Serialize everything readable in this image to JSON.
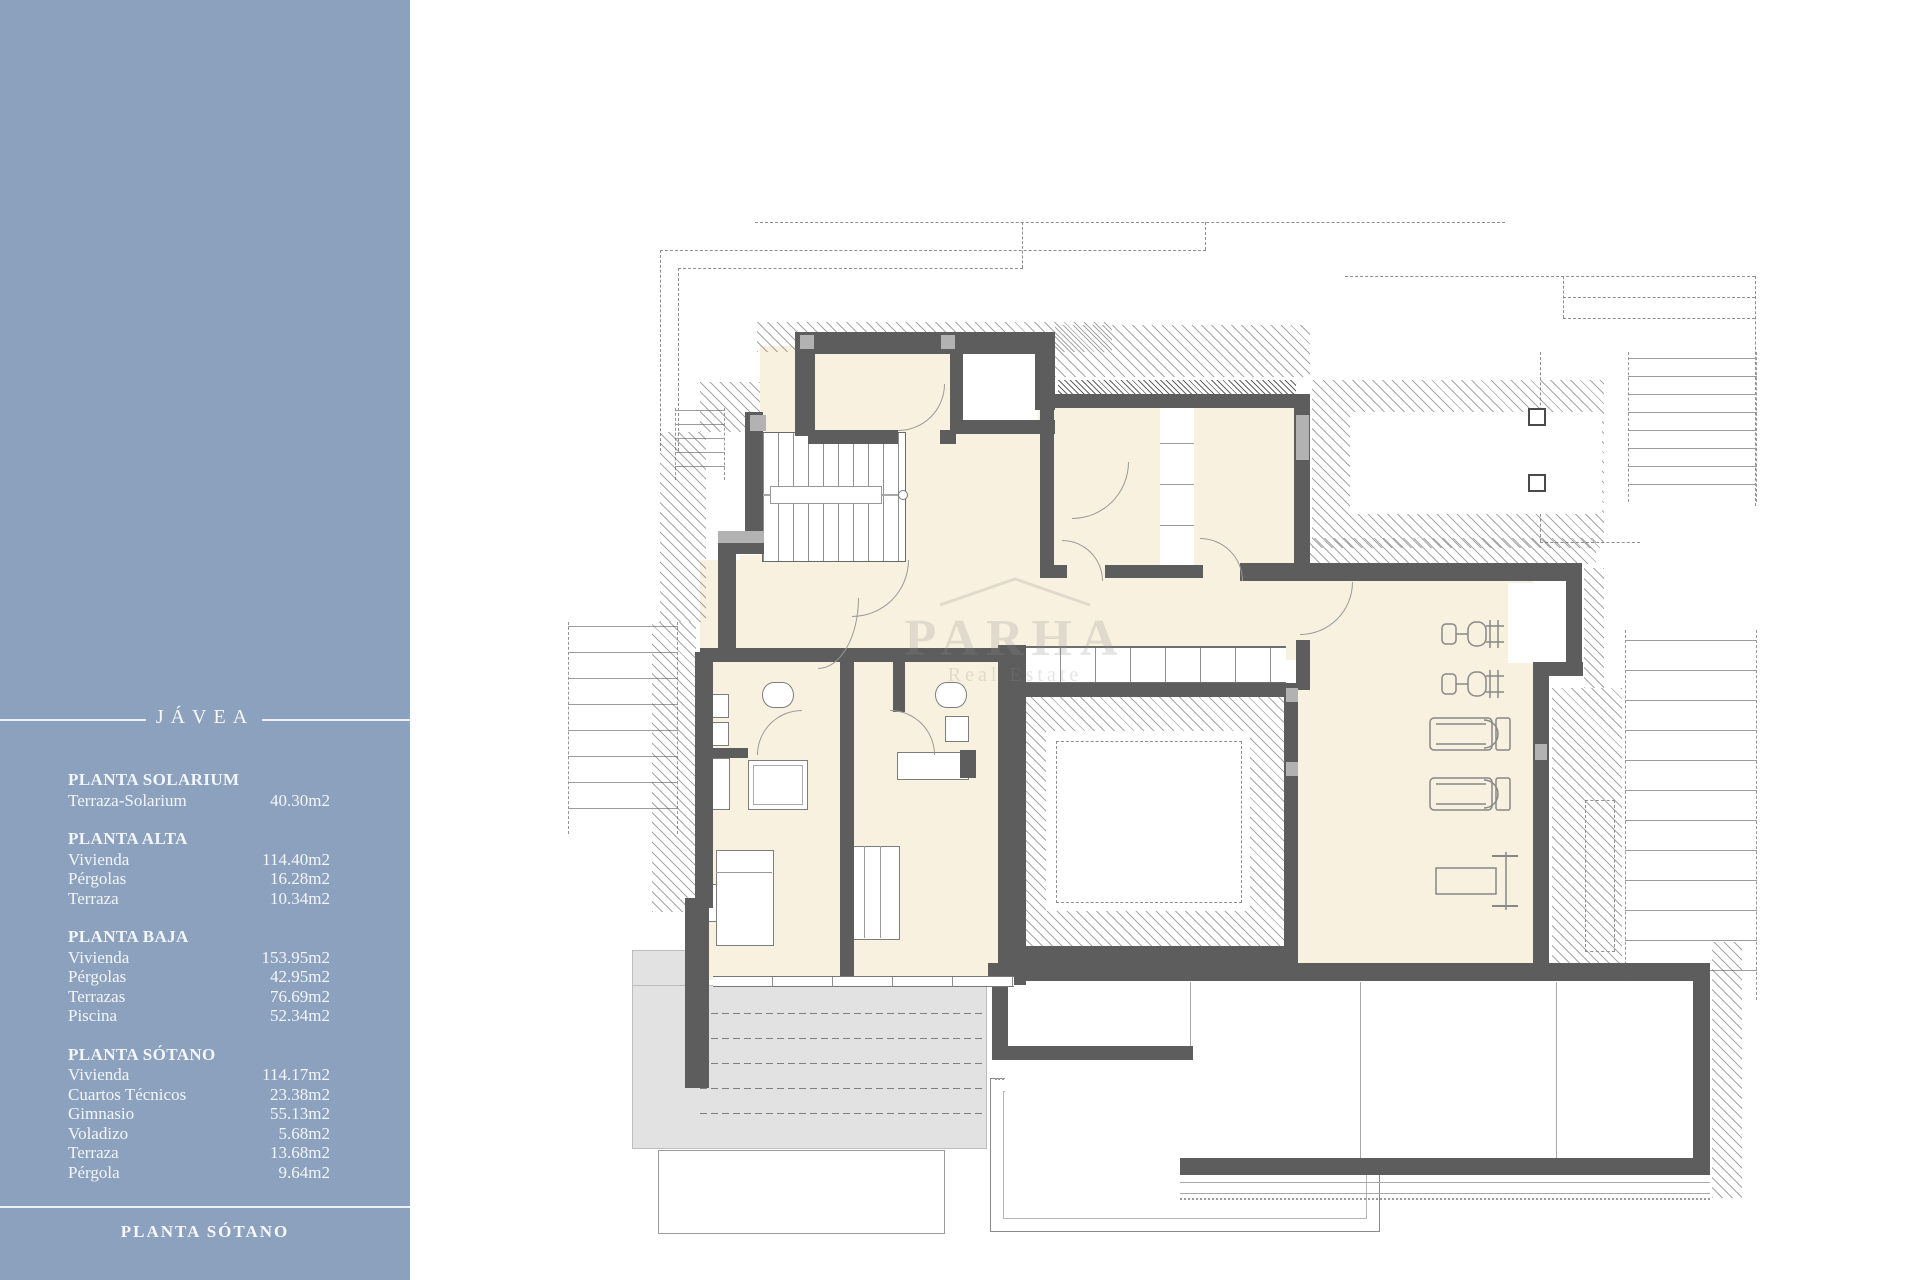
{
  "sidebar": {
    "color": "#8ca1bd",
    "title": "JÁVEA",
    "sections": [
      {
        "header": "PLANTA SOLARIUM",
        "rows": [
          {
            "label": "Terraza-Solarium",
            "value": "40.30m2"
          }
        ]
      },
      {
        "header": "PLANTA ALTA",
        "rows": [
          {
            "label": "Vivienda",
            "value": "114.40m2"
          },
          {
            "label": "Pérgolas",
            "value": "16.28m2"
          },
          {
            "label": "Terraza",
            "value": "10.34m2"
          }
        ]
      },
      {
        "header": "PLANTA BAJA",
        "rows": [
          {
            "label": "Vivienda",
            "value": "153.95m2"
          },
          {
            "label": "Pérgolas",
            "value": "42.95m2"
          },
          {
            "label": "Terrazas",
            "value": "76.69m2"
          },
          {
            "label": "Piscina",
            "value": "52.34m2"
          }
        ]
      },
      {
        "header": "PLANTA SÓTANO",
        "rows": [
          {
            "label": "Vivienda",
            "value": "114.17m2"
          },
          {
            "label": "Cuartos Técnicos",
            "value": "23.38m2"
          },
          {
            "label": "Gimnasio",
            "value": "55.13m2"
          },
          {
            "label": "Voladizo",
            "value": "5.68m2"
          },
          {
            "label": "Terraza",
            "value": "13.68m2"
          },
          {
            "label": "Pérgola",
            "value": "9.64m2"
          }
        ]
      }
    ],
    "footer": "PLANTA SÓTANO"
  },
  "plan": {
    "watermark": {
      "main": "PARHA",
      "sub": "Real Estate"
    },
    "colors": {
      "wall": "#5d5d5d",
      "room_fill": "#f8f1df",
      "terrace_fill": "#e2e2e2",
      "pilaster": "#b2b2b2",
      "sidebar": "#8ca1bd"
    }
  }
}
